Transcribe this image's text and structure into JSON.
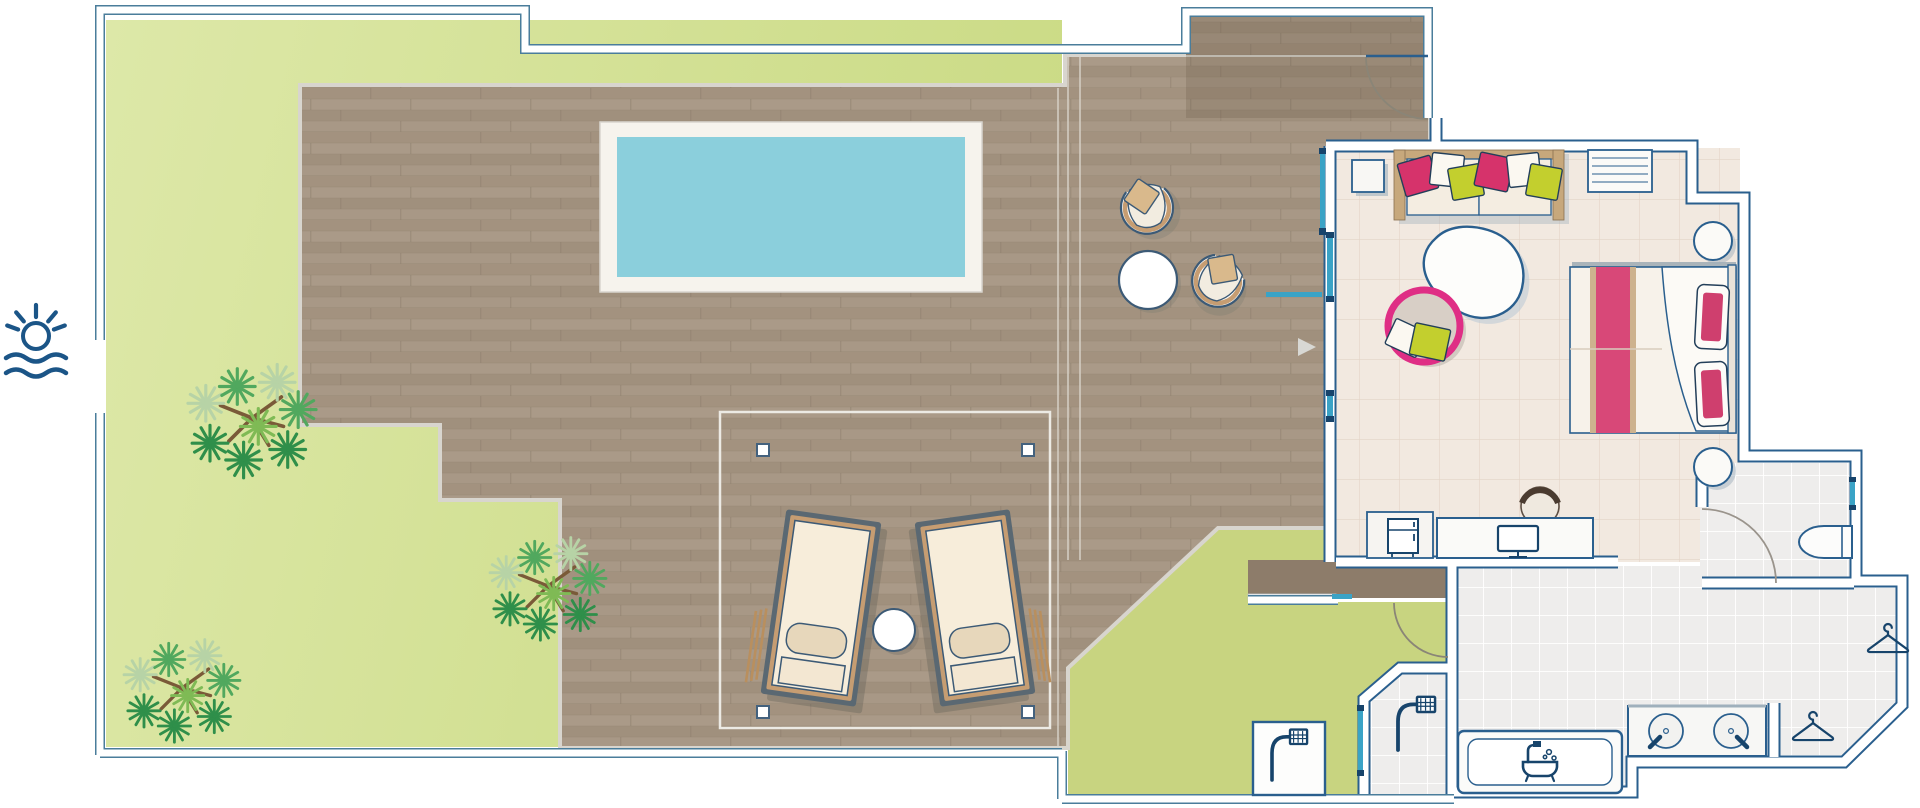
{
  "meta": {
    "type": "floor-plan",
    "description": "Top-down architectural floor plan of a suite with private pool, wooden deck, garden, bedroom and bathroom",
    "visible_text": "none"
  },
  "colors": {
    "page_bg": "#ffffff",
    "site_outline": "#4a7d9b",
    "wall_line": "#2a5f8e",
    "fixture_line": "#17446b",
    "glass_teal": "#3aa3c6",
    "garden_light": "#dde8a8",
    "garden_dark": "#cbdb86",
    "courtyard_green": "#c8d480",
    "deck_wood": "#a79684",
    "deck_row_a": "#a3927f",
    "deck_row_b": "#aa9a88",
    "deck_row_c": "#a0907d",
    "deck_row_d": "#a89886",
    "walkway_dark": "#8d7c6a",
    "porch_shade": "#5c4a36",
    "pool_water": "#8bcfdc",
    "pool_frame": "#f6f3ed",
    "deck_trim": "#d8d5ce",
    "bedroom_floor": "#f2e9e0",
    "bedroom_grid": "#e3d4c7",
    "bath_floor": "#eeedec",
    "bath_grid": "#ffffff",
    "accent_pink": "#d6336b",
    "accent_lime": "#c3cf2e",
    "bed_runner": "#d84878",
    "runner_edge": "#cdb28e",
    "cushion_tan": "#c69d72",
    "cushion_cream": "#f7edda",
    "lounger_frame": "#5a6872",
    "sofa_wood": "#c7a87c",
    "hanging_chair_pink": "#df2e85",
    "palm_dark": "#2f8f4a",
    "palm_mid": "#51a85e",
    "palm_light": "#86bd7a",
    "palm_pale": "#b7d3a6",
    "palm_trunk": "#7a5a38",
    "logo_blue": "#1b5587",
    "arc_line": "#8a8577"
  },
  "areas": {
    "garden": {
      "label": "garden lawn",
      "palm_trees": 3
    },
    "deck": {
      "label": "timber pool deck",
      "pergola_posts": 4
    },
    "pool": {
      "label": "private pool"
    },
    "porch": {
      "label": "covered entrance"
    },
    "bedroom": {
      "label": "bedroom / living room"
    },
    "courtyard": {
      "label": "outdoor shower courtyard"
    },
    "bathroom": {
      "label": "bathroom"
    },
    "wc": {
      "label": "toilet room"
    },
    "closet": {
      "label": "walk-in wardrobe",
      "hangers": 2
    }
  },
  "furniture": {
    "sun_loungers": 2,
    "lounge_chairs": 2,
    "round_tables": 2,
    "sofa": {
      "pillows": [
        "pink",
        "white",
        "lime",
        "pink",
        "white",
        "lime"
      ]
    },
    "double_bed": {
      "pillows": 2,
      "runner": "pink"
    },
    "hanging_chair": 1,
    "rug": 1,
    "side_tables_round": 2,
    "desk_with_monitor": 1,
    "stool": 1,
    "minibar": 1,
    "shelf_unit": 1,
    "bathtub": 1,
    "showers": 2,
    "sinks": 2,
    "toilet": 1
  }
}
